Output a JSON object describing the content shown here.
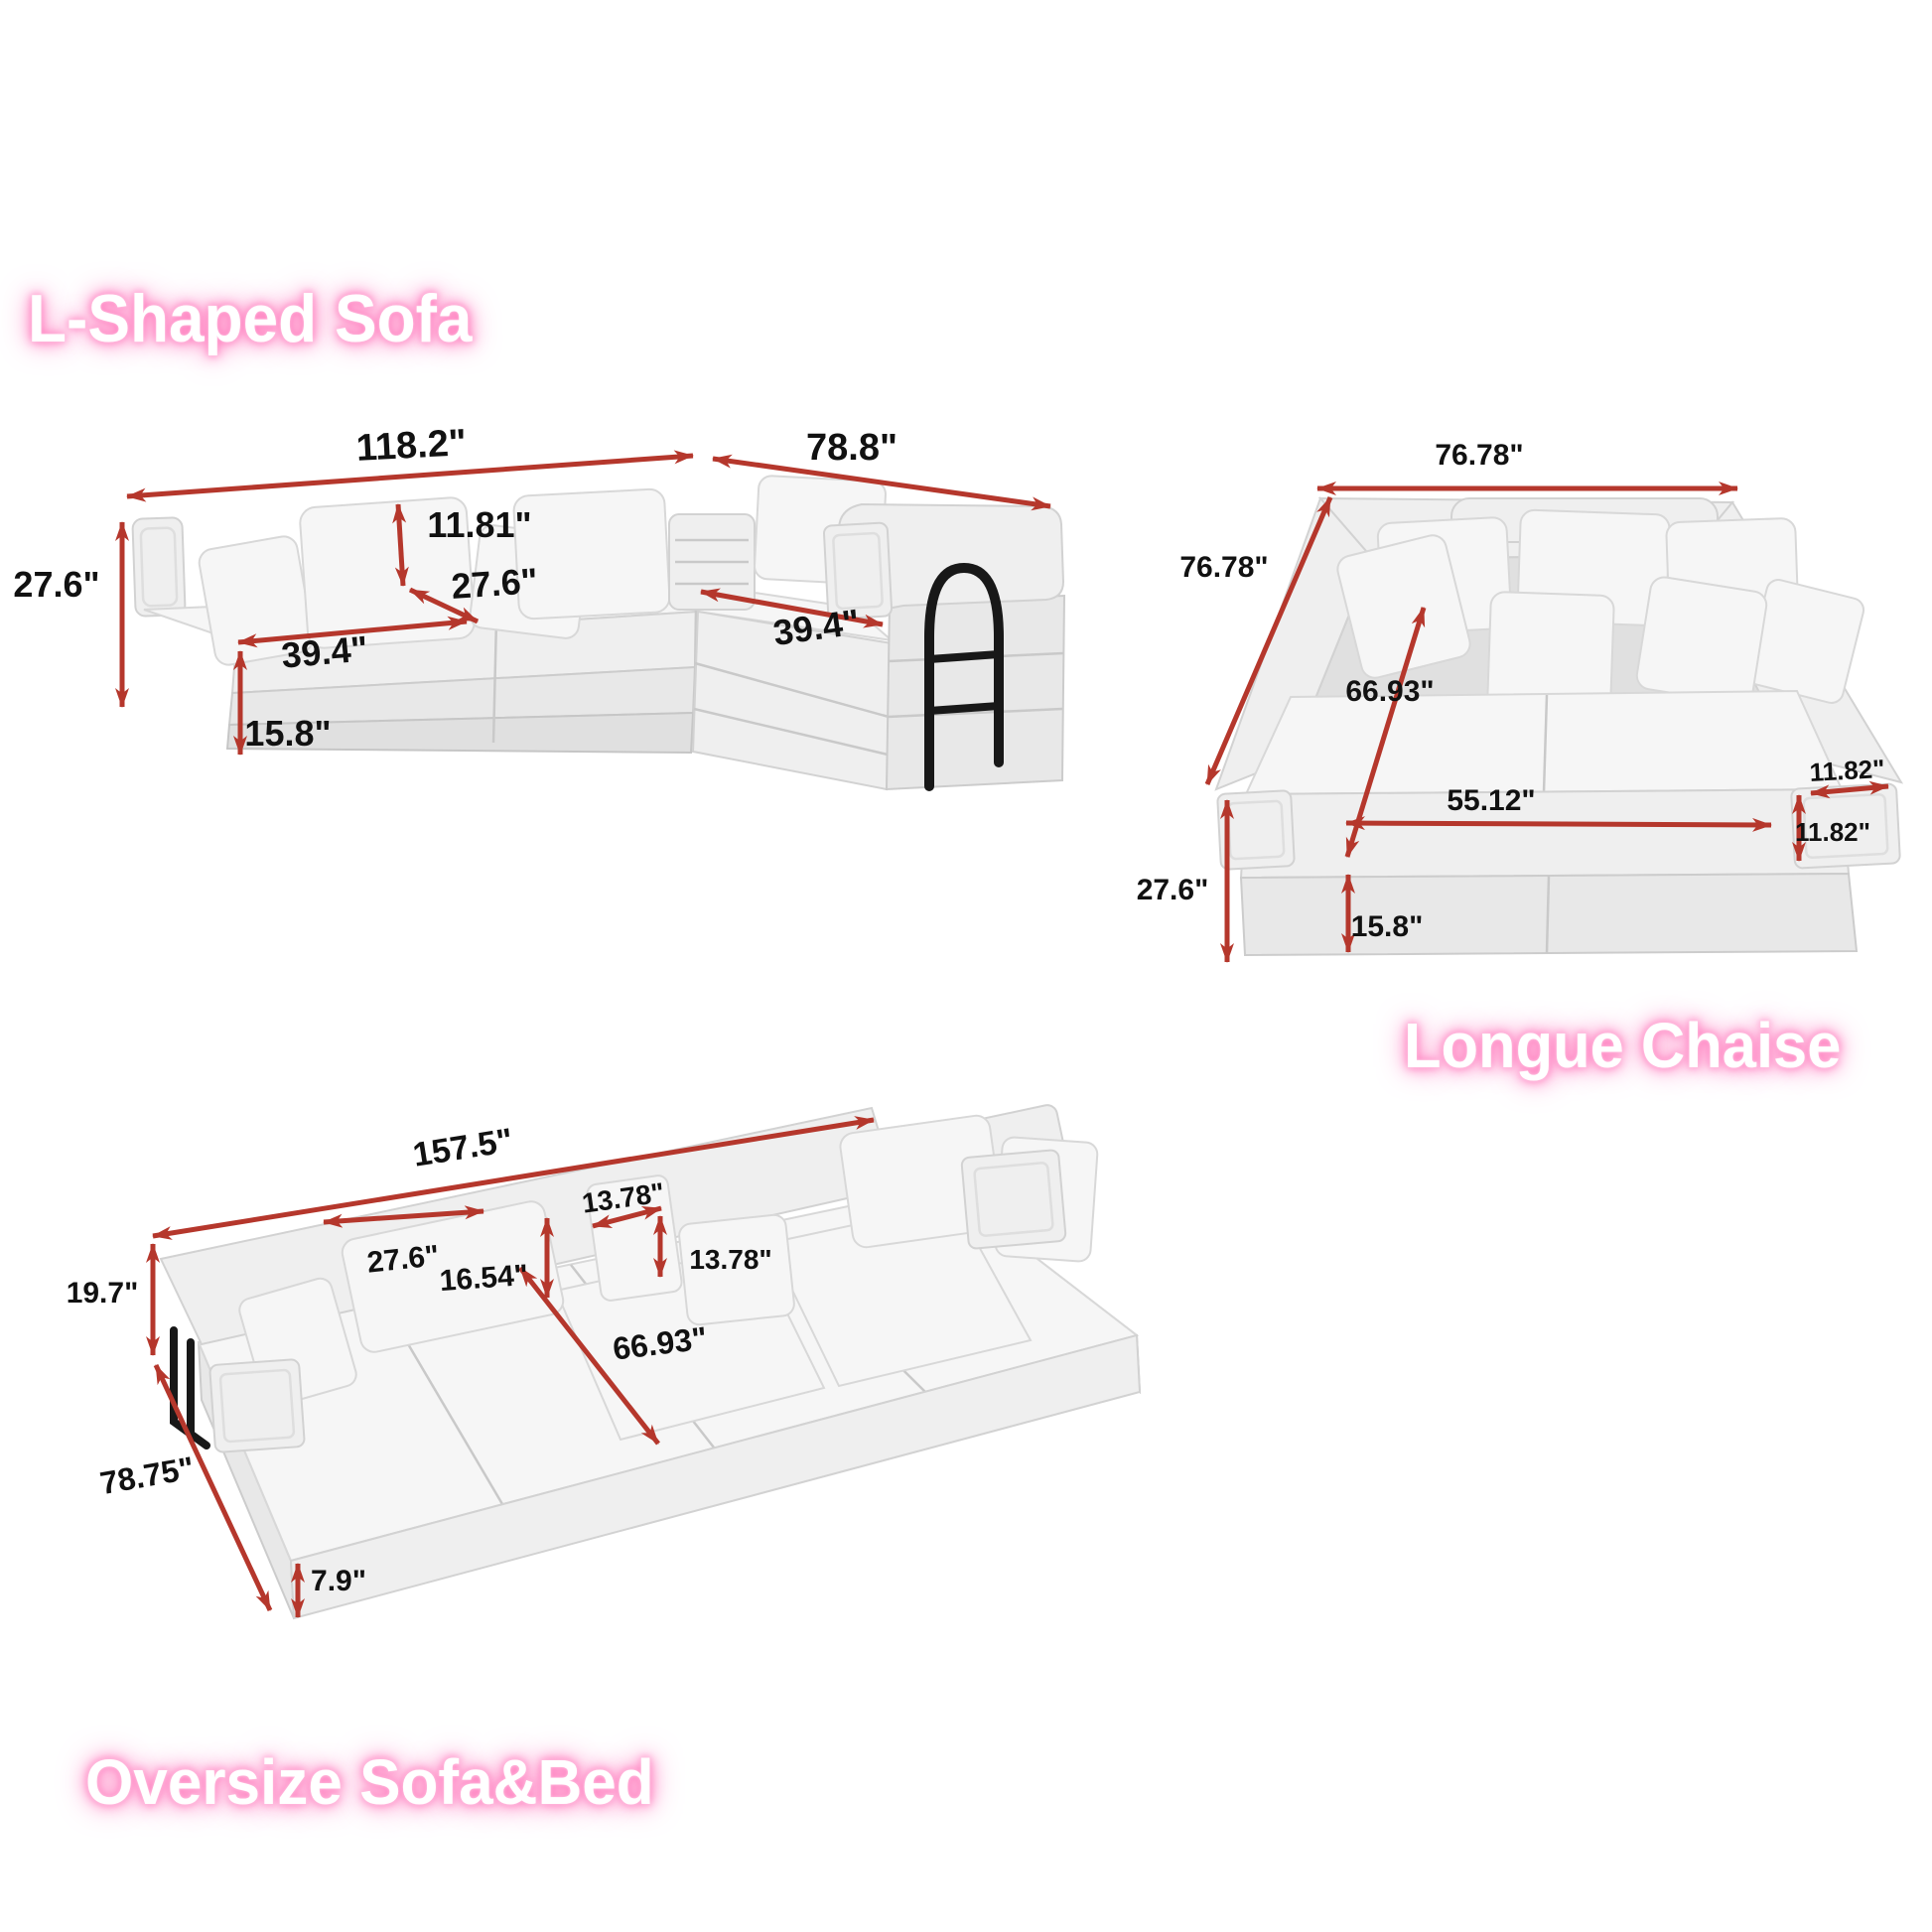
{
  "colors": {
    "arrow": "#b5372c",
    "label": "#111111",
    "title_text": "#ffffff",
    "title_glow": "#ff7bbd",
    "sofa_fabric": "#f2f2f2",
    "metal_frame": "#181818"
  },
  "sections": {
    "l_shaped_sofa": {
      "title": "L-Shaped Sofa",
      "dims": {
        "total_width": "118.2\"",
        "total_depth": "78.8\"",
        "total_height": "27.6\"",
        "back_cushion_height": "11.81\"",
        "seat_depth": "27.6\"",
        "left_seat_width": "39.4\"",
        "right_seat_width": "39.4\"",
        "base_height": "15.8\""
      }
    },
    "longue_chaise": {
      "title": "Longue Chaise",
      "dims": {
        "total_width": "76.78\"",
        "total_depth": "76.78\"",
        "inner_diagonal": "66.93\"",
        "inner_width": "55.12\"",
        "arm_width": "11.82\"",
        "arm_height": "11.82\"",
        "total_height": "27.6\"",
        "base_height": "15.8\""
      }
    },
    "oversize_sofa_bed": {
      "title": "Oversize Sofa&Bed",
      "dims": {
        "total_length": "157.5\"",
        "back_height": "19.7\"",
        "pillow_width": "27.6\"",
        "pillow_height": "16.54\"",
        "small_pillow_width": "13.78\"",
        "small_pillow_height": "13.78\"",
        "inner_length": "66.93\"",
        "total_width": "78.75\"",
        "mattress_height": "7.9\""
      }
    }
  }
}
